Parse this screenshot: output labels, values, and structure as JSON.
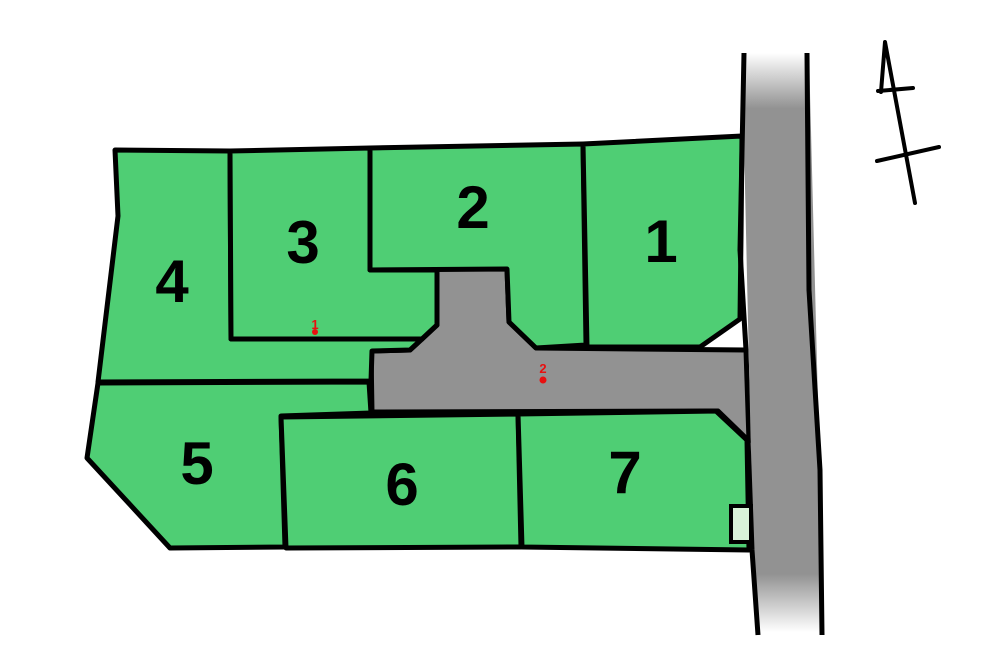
{
  "map": {
    "name": "land-lot-site-plan",
    "plots": [
      {
        "label": "1"
      },
      {
        "label": "2"
      },
      {
        "label": "3"
      },
      {
        "label": "4"
      },
      {
        "label": "5"
      },
      {
        "label": "6"
      },
      {
        "label": "7"
      }
    ],
    "markers": [
      {
        "label": "1"
      },
      {
        "label": "2"
      }
    ],
    "icons": {
      "north_arrow": "north-arrow"
    },
    "colors": {
      "plot_fill": "#4fce74",
      "road_fill": "#929292",
      "marker_red": "#e81010",
      "outline_box_fill": "#d8f3d8",
      "line_black": "#000000",
      "background": "#ffffff"
    }
  }
}
